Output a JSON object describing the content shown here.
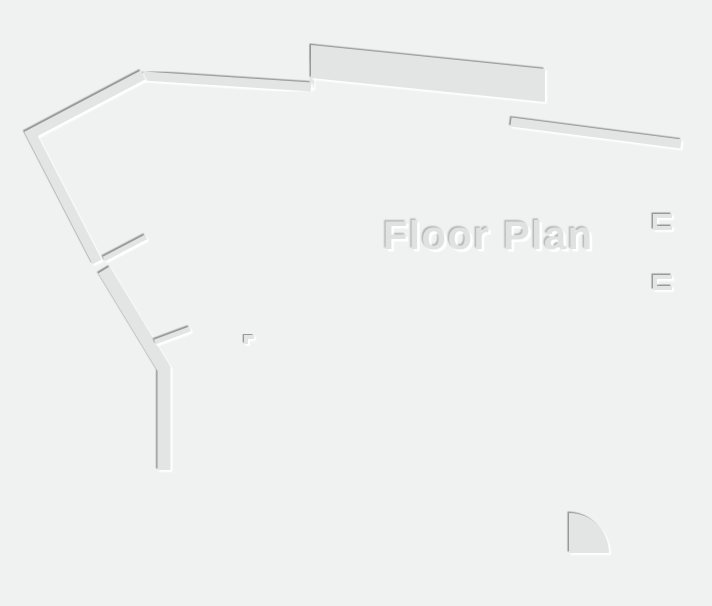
{
  "floorplan": {
    "title": "Floor Plan",
    "colors": {
      "background": "#f0f1f1",
      "wall_fill": "#e3e5e5",
      "wall_shadow": "#8f9192",
      "wall_highlight": "#ffffff",
      "title_fill": "#e0e2e2"
    }
  }
}
